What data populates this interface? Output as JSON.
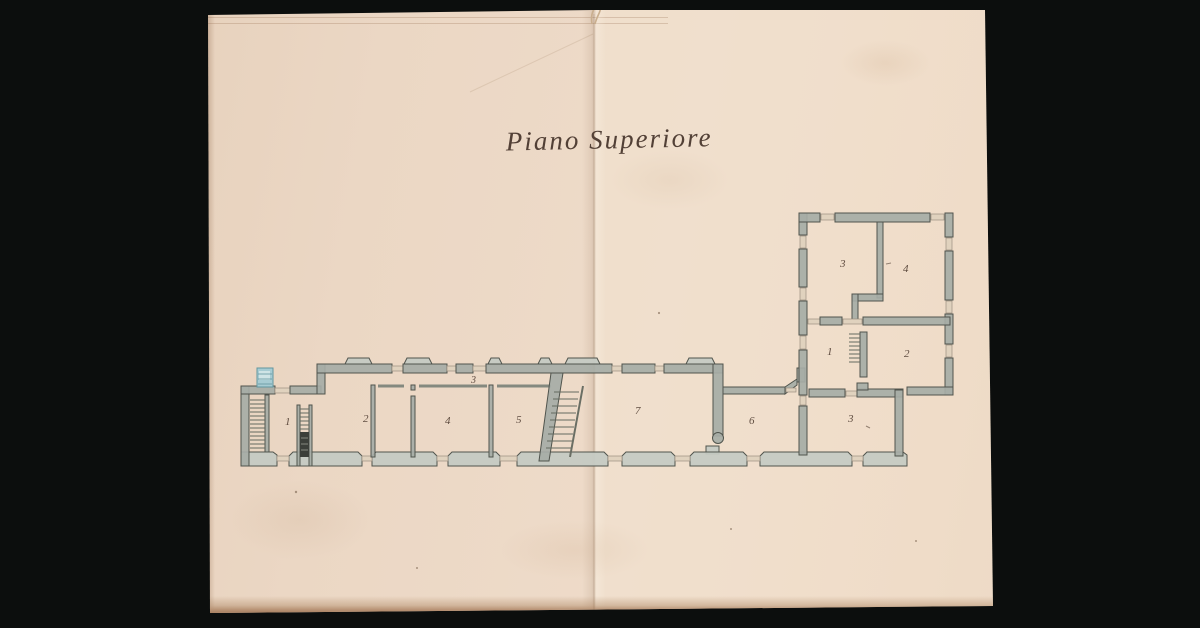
{
  "document": {
    "title": "Piano Superiore"
  },
  "plan": {
    "room_labels": [
      {
        "label": "1",
        "x": 285,
        "y": 425
      },
      {
        "label": "2",
        "x": 363,
        "y": 422
      },
      {
        "label": "3",
        "x": 471,
        "y": 383,
        "small": true
      },
      {
        "label": "4",
        "x": 445,
        "y": 424
      },
      {
        "label": "5",
        "x": 516,
        "y": 423
      },
      {
        "label": "7",
        "x": 635,
        "y": 414
      },
      {
        "label": "6",
        "x": 749,
        "y": 424
      },
      {
        "label": "3",
        "x": 848,
        "y": 422
      },
      {
        "label": "1",
        "x": 827,
        "y": 355
      },
      {
        "label": "2",
        "x": 904,
        "y": 357
      },
      {
        "label": "3",
        "x": 840,
        "y": 267
      },
      {
        "label": "4",
        "x": 903,
        "y": 272
      }
    ]
  },
  "palette": {
    "bg": "#0c0e0d",
    "paper": "#ebd7c4",
    "wall": "#a6aca6",
    "wall_light": "#c5cac3",
    "wall_edge": "#50544d",
    "thin_wall": "#84897f",
    "hatch": "#646a60",
    "stair_dark": "#3c3f39",
    "sill": "#e0d2be",
    "sill_edge": "#9a8f80",
    "blue": "#a7ccd3",
    "blue_edge": "#62969f",
    "ink": "#524036",
    "ink_light": "#5f4c40"
  }
}
